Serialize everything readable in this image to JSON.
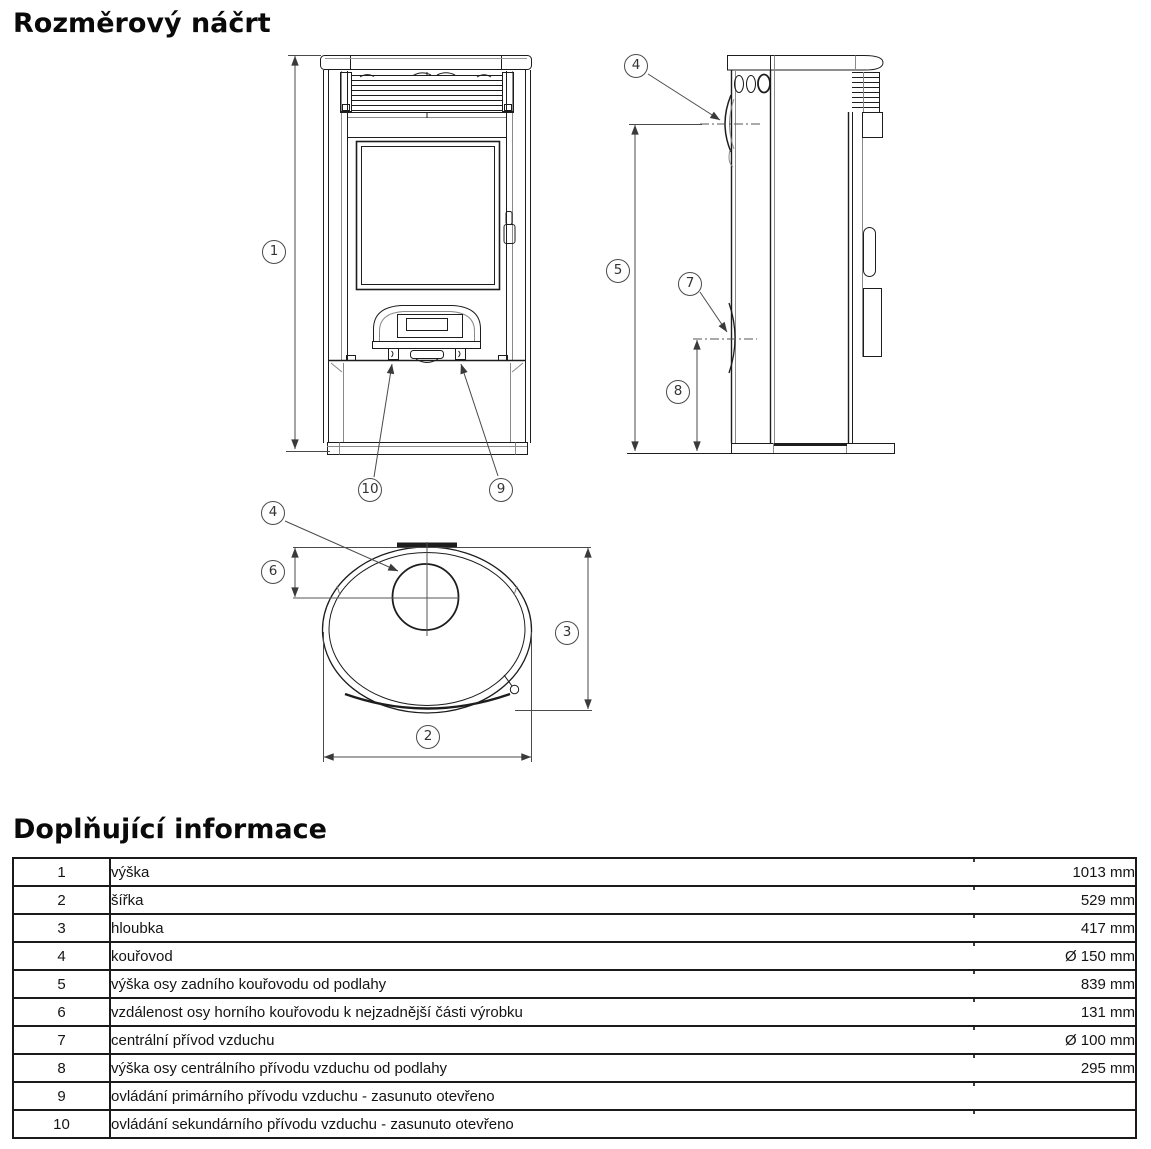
{
  "page": {
    "title": "Rozměrový náčrt",
    "info_title": "Doplňující informace"
  },
  "drawing": {
    "description": "three technical views of an oval wood stove: front, side, top",
    "callouts": [
      {
        "label": "1"
      },
      {
        "label": "10"
      },
      {
        "label": "9"
      },
      {
        "label": "4"
      },
      {
        "label": "5"
      },
      {
        "label": "7"
      },
      {
        "label": "8"
      },
      {
        "label": "4"
      },
      {
        "label": "6"
      },
      {
        "label": "3"
      },
      {
        "label": "2"
      }
    ]
  },
  "table": {
    "rows": [
      {
        "num": "1",
        "label": "výška",
        "value": "1013 mm"
      },
      {
        "num": "2",
        "label": "šířka",
        "value": "529 mm"
      },
      {
        "num": "3",
        "label": "hloubka",
        "value": "417 mm"
      },
      {
        "num": "4",
        "label": "kouřovod",
        "value": "Ø 150 mm"
      },
      {
        "num": "5",
        "label": "výška osy zadního kouřovodu od podlahy",
        "value": "839 mm"
      },
      {
        "num": "6",
        "label": "vzdálenost osy horního kouřovodu k nejzadnější části výrobku",
        "value": "131 mm"
      },
      {
        "num": "7",
        "label": "centrální přívod vzduchu",
        "value": "Ø 100 mm"
      },
      {
        "num": "8",
        "label": "výška osy centrálního přívodu vzduchu od podlahy",
        "value": "295 mm"
      },
      {
        "num": "9",
        "label": "ovládání primárního přívodu vzduchu - zasunuto otevřeno",
        "value": ""
      },
      {
        "num": "10",
        "label": "ovládání sekundárního přívodu vzduchu - zasunuto otevřeno",
        "value": ""
      }
    ]
  }
}
